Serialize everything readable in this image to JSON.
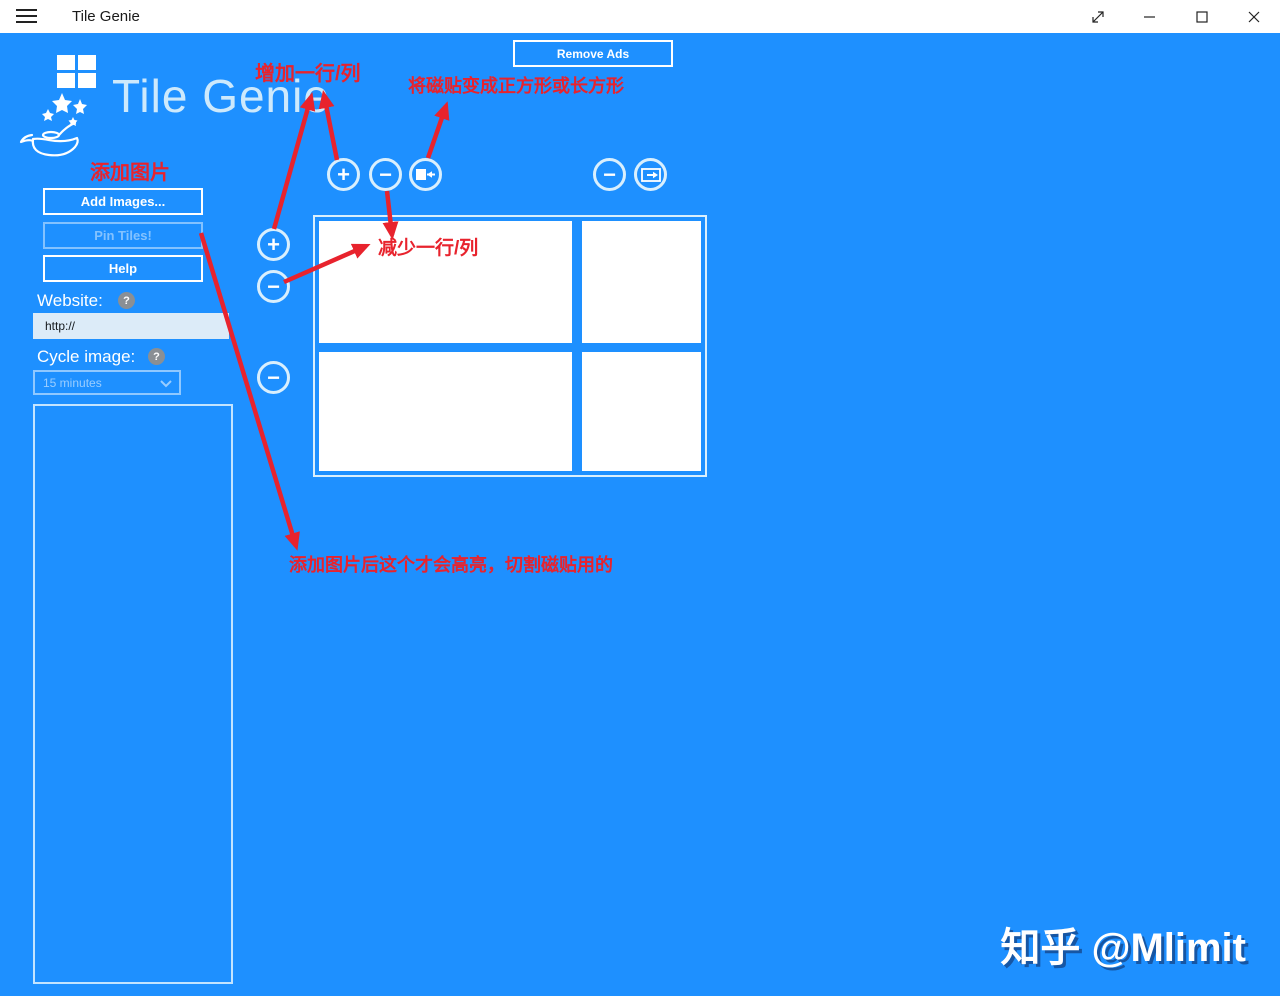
{
  "titlebar": {
    "title": "Tile Genie"
  },
  "header": {
    "app_title": "Tile Genie",
    "remove_ads_label": "Remove Ads"
  },
  "sidebar": {
    "add_images_label": "Add Images...",
    "pin_tiles_label": "Pin Tiles!",
    "help_label": "Help",
    "website_label": "Website:",
    "website_value": "http://",
    "cycle_label": "Cycle image:",
    "cycle_value": "15 minutes"
  },
  "annotations": {
    "add_row_col": "增加一行/列",
    "make_square": "将磁贴变成正方形或长方形",
    "add_images": "添加图片",
    "remove_row_col": "减少一行/列",
    "pin_note": "添加图片后这个才会高亮，切割磁贴用的"
  },
  "icons": {
    "plus": "+",
    "minus": "−",
    "question": "?"
  },
  "watermark": "知乎 @Mlimit",
  "colors": {
    "background": "#1E90FF",
    "annotation_red": "#E8232D",
    "tile_white": "#FFFFFF",
    "titlebar_bg": "#FFFFFF"
  }
}
